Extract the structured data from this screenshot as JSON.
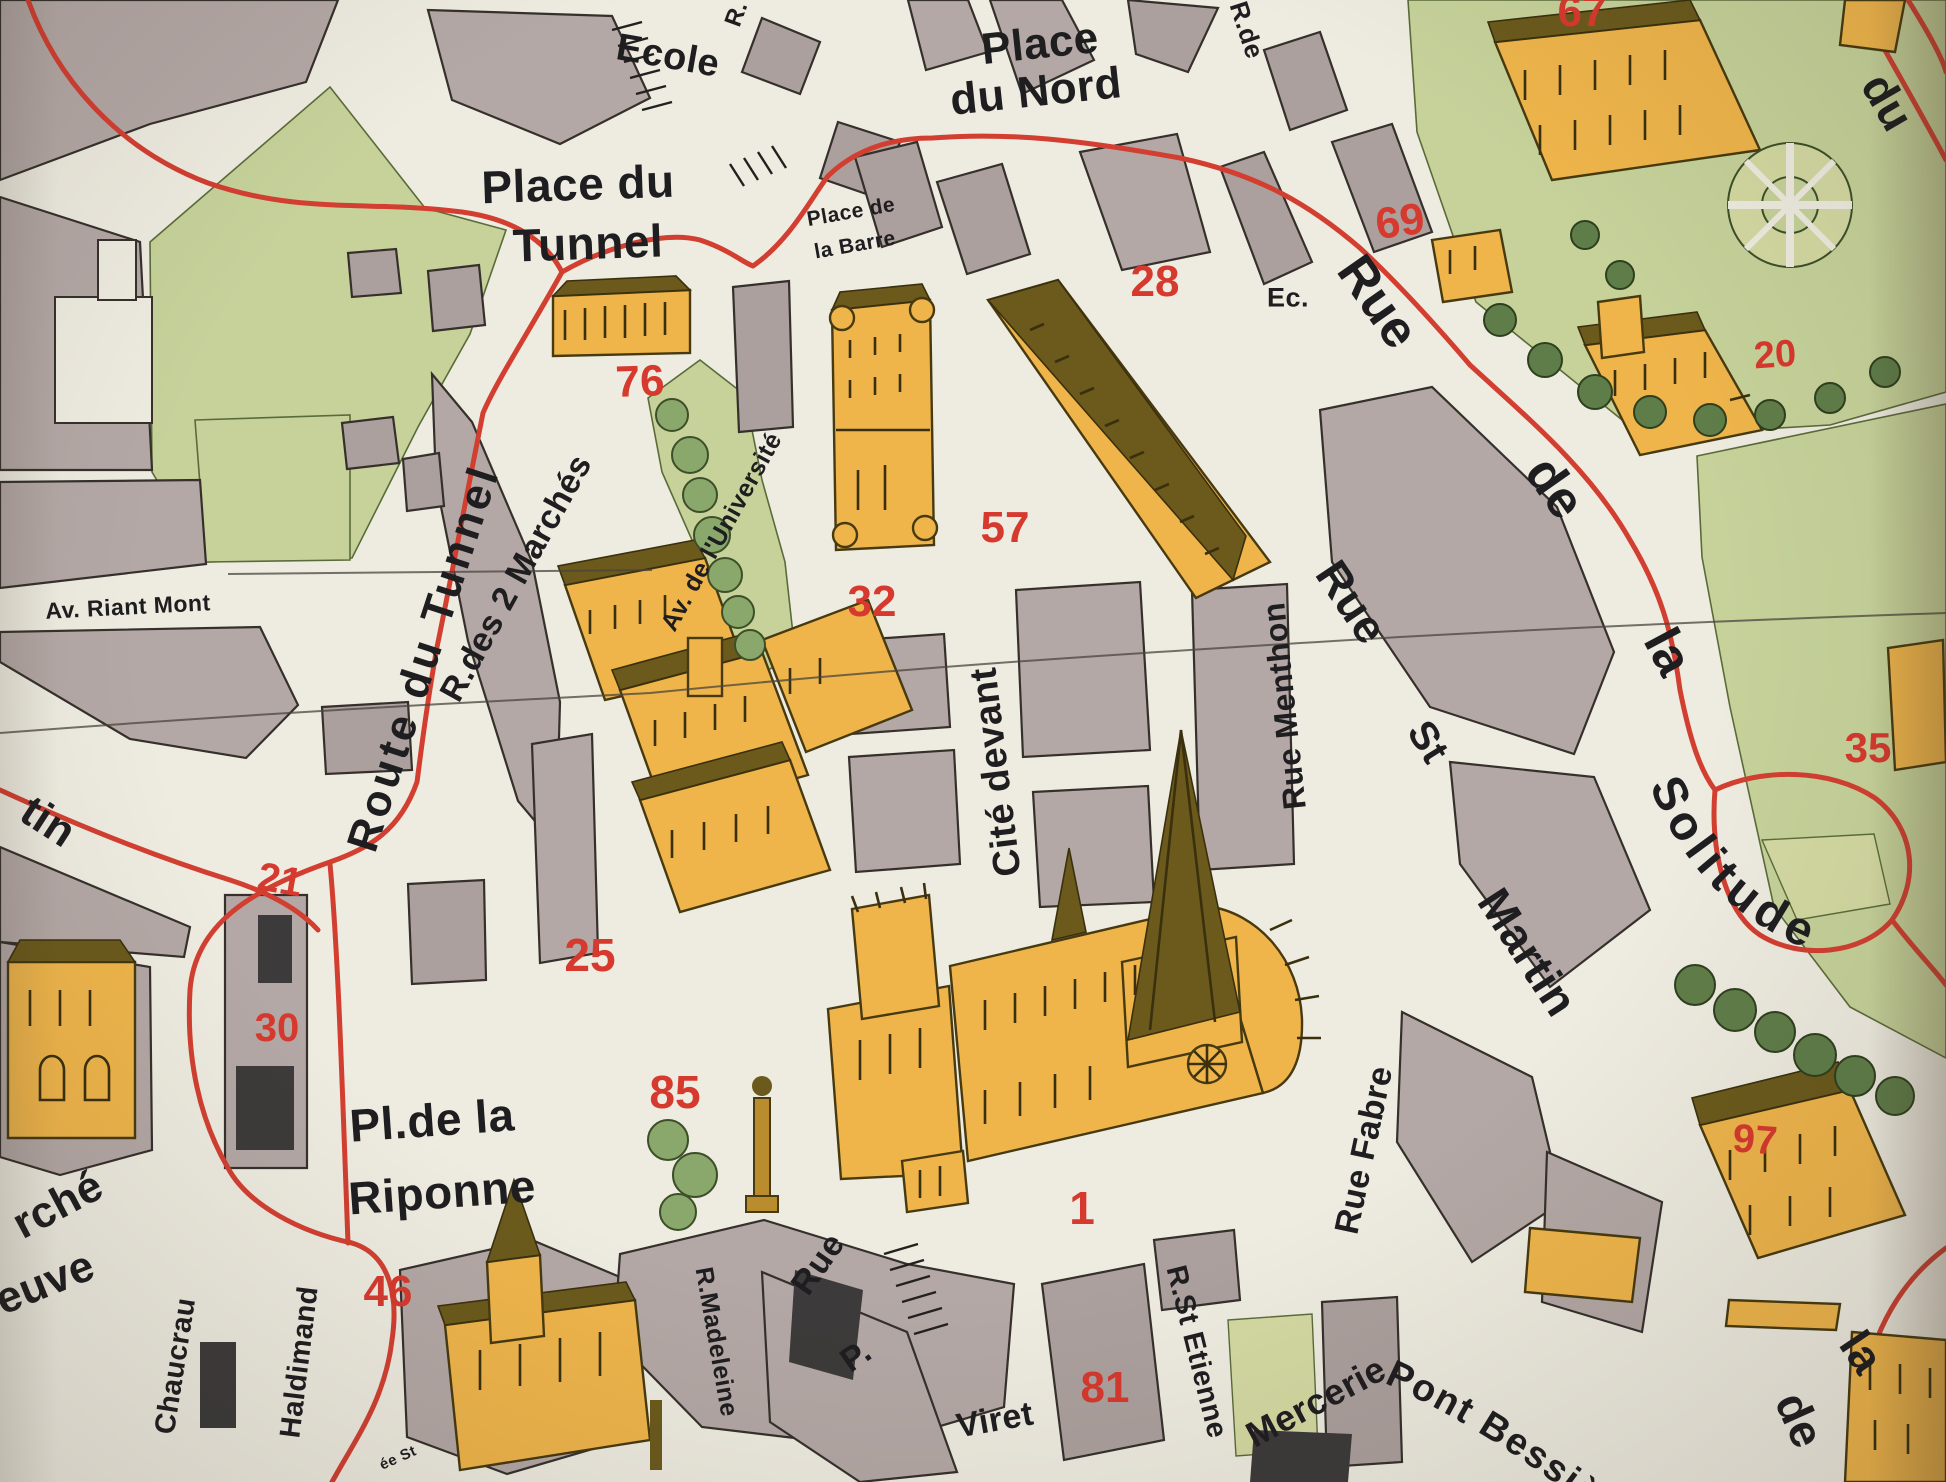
{
  "map": {
    "type": "vintage pictorial street map",
    "colors": {
      "paper": "#eeebe0",
      "city_block": "#b4a8a6",
      "park_green": "#c6d29a",
      "building_orange": "#efb54b",
      "route_red": "#d23f31",
      "number_red": "#d6392e",
      "ink": "#1e1d20"
    },
    "labels": {
      "ecole": "Ecole",
      "place_du_nord_1": "Place",
      "place_du_nord_2": "du Nord",
      "place_barre_1": "Place de",
      "place_barre_2": "la Barre",
      "place_tunnel_1": "Place du",
      "place_tunnel_2": "Tunnel",
      "r_abbrev_top": "R.",
      "r_de_abbrev": "R.de",
      "ec_abbrev": "Ec.",
      "solitude_rue": "Rue",
      "solitude_de": "de",
      "solitude_la": "la",
      "solitude_main": "Solitude",
      "route_du_tunnel": "Route du Tunnel",
      "rue_des_2_marches": "R.des 2 Marchés",
      "av_universite": "Av. de l'Université",
      "av_riant_mont": "Av. Riant Mont",
      "tin_partial": "tin",
      "riponne_1": "Pl.de la",
      "riponne_2": "Riponne",
      "marche_partial": "rché",
      "neuve_partial": "euve",
      "chaucrau": "Chaucrau",
      "haldimand": "Haldimand",
      "montee_partial": "ée St",
      "r_madeleine": "R.Madeleine",
      "viret_rue": "Rue",
      "viret_p": "P.",
      "viret_name": "Viret",
      "r_st_etienne": "R.St Etienne",
      "mercerie": "Mercerie",
      "pont_bessieres": "Pont Bessières",
      "de_partial": "de",
      "la_partial": "la",
      "du_partial": "du",
      "cite_devant": "Cité devant",
      "rue_menthon": "Rue Menthon",
      "st_martin_rue": "Rue",
      "st_martin_st": "St",
      "st_martin_name": "Martin",
      "rue_fabre": "Rue Fabre"
    },
    "numbers": {
      "n1": "1",
      "n20": "20",
      "n21": "21",
      "n25": "25",
      "n28": "28",
      "n30": "30",
      "n32": "32",
      "n35": "35",
      "n46": "46",
      "n57": "57",
      "n67": "67",
      "n69": "69",
      "n76": "76",
      "n81": "81",
      "n85": "85",
      "n97": "97"
    }
  }
}
